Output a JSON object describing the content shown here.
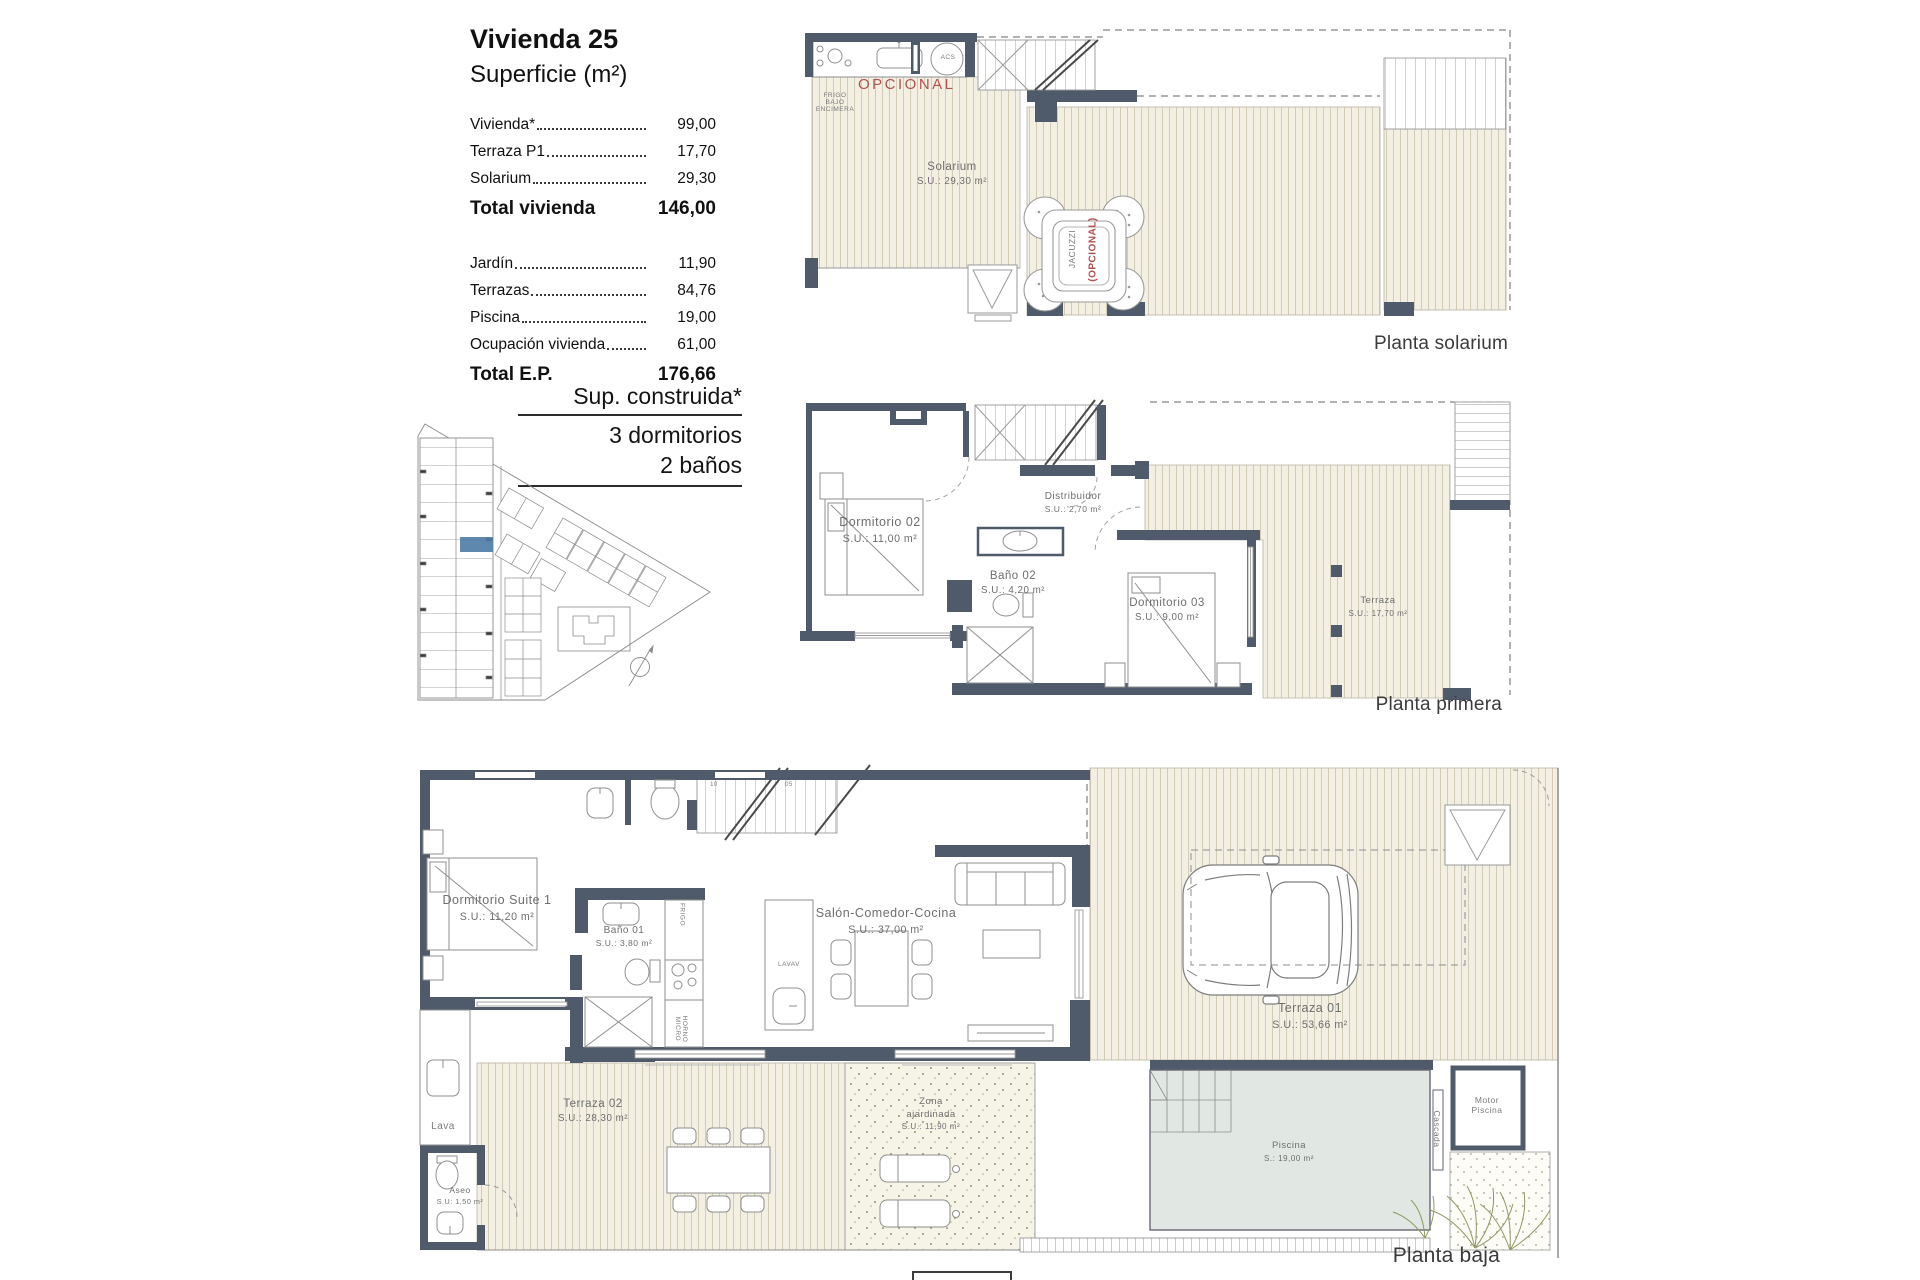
{
  "info_panel": {
    "title": "Vivienda 25",
    "subtitle": "Superficie (m²)",
    "rows": [
      {
        "label": "Vivienda*",
        "value": "99,00"
      },
      {
        "label": "Terraza P1",
        "value": "17,70"
      },
      {
        "label": "Solarium",
        "value": "29,30"
      }
    ],
    "total1": {
      "label": "Total vivienda",
      "value": "146,00"
    },
    "rows2": [
      {
        "label": "Jardín",
        "value": "11,90"
      },
      {
        "label": "Terrazas",
        "value": "84,76"
      },
      {
        "label": "Piscina",
        "value": "19,00"
      },
      {
        "label": "Ocupación vivienda",
        "value": "61,00"
      }
    ],
    "total2": {
      "label": "Total E.P.",
      "value": "176,66"
    }
  },
  "spec": {
    "line1": "Sup. construida*",
    "line2": "3 dormitorios",
    "line3": "2 baños"
  },
  "plans": {
    "solarium": {
      "caption": "Planta solarium",
      "opcional": "OPCIONAL",
      "frigo": "FRIGO\nBAJO\nENCIMERA",
      "acs": "ACS",
      "room": {
        "name": "Solarium",
        "area": "S.U.: 29,30 m²"
      },
      "jacuzzi": "JACUZZI",
      "jacuzzi_opt": "(OPCIONAL)"
    },
    "primera": {
      "caption": "Planta primera",
      "rooms": [
        {
          "name": "Dormitorio 02",
          "area": "S.U.: 11,00 m²"
        },
        {
          "name": "Distribuidor",
          "area": "S.U.: 2,70 m²"
        },
        {
          "name": "Baño 02",
          "area": "S.U.: 4,20 m²"
        },
        {
          "name": "Dormitorio 03",
          "area": "S.U.: 9,00 m²"
        },
        {
          "name": "Terraza",
          "area": "S.U.: 17,70 m²"
        }
      ]
    },
    "baja": {
      "caption": "Planta baja",
      "rooms": [
        {
          "name": "Dormitorio Suite 1",
          "area": "S.U.: 11,20 m²"
        },
        {
          "name": "Baño 01",
          "area": "S.U.: 3,80 m²"
        },
        {
          "name": "Salón-Comedor-Cocina",
          "area": "S.U.: 37,00 m²"
        },
        {
          "name": "Terraza 02",
          "area": "S.U.: 28,30 m²"
        },
        {
          "name": "Zona\najardinada",
          "area": "S.U.: 11,90 m²"
        },
        {
          "name": "Terraza 01",
          "area": "S.U.: 53,66 m²"
        },
        {
          "name": "Piscina",
          "area": "S.: 19,00 m²"
        },
        {
          "name": "Aseo",
          "area": "S.U: 1,50 m²"
        }
      ],
      "labels": {
        "lava": "Lava",
        "motor": "Motor\nPiscina",
        "cascada": "Cascada",
        "lavav": "LAVAV",
        "frigo": "FRIGO",
        "horno": "HORNO\nMICRO",
        "stair_num1": "10",
        "stair_num2": "05"
      }
    }
  },
  "palette": {
    "wall": "#4f5b6b",
    "deck_bg": "#f3efe3",
    "deck_line": "#cfc8b2",
    "accent_red": "#b0524e",
    "site_highlight": "#4e7ba6",
    "pool": "#e1e8e3",
    "plant": "#8f9762"
  }
}
